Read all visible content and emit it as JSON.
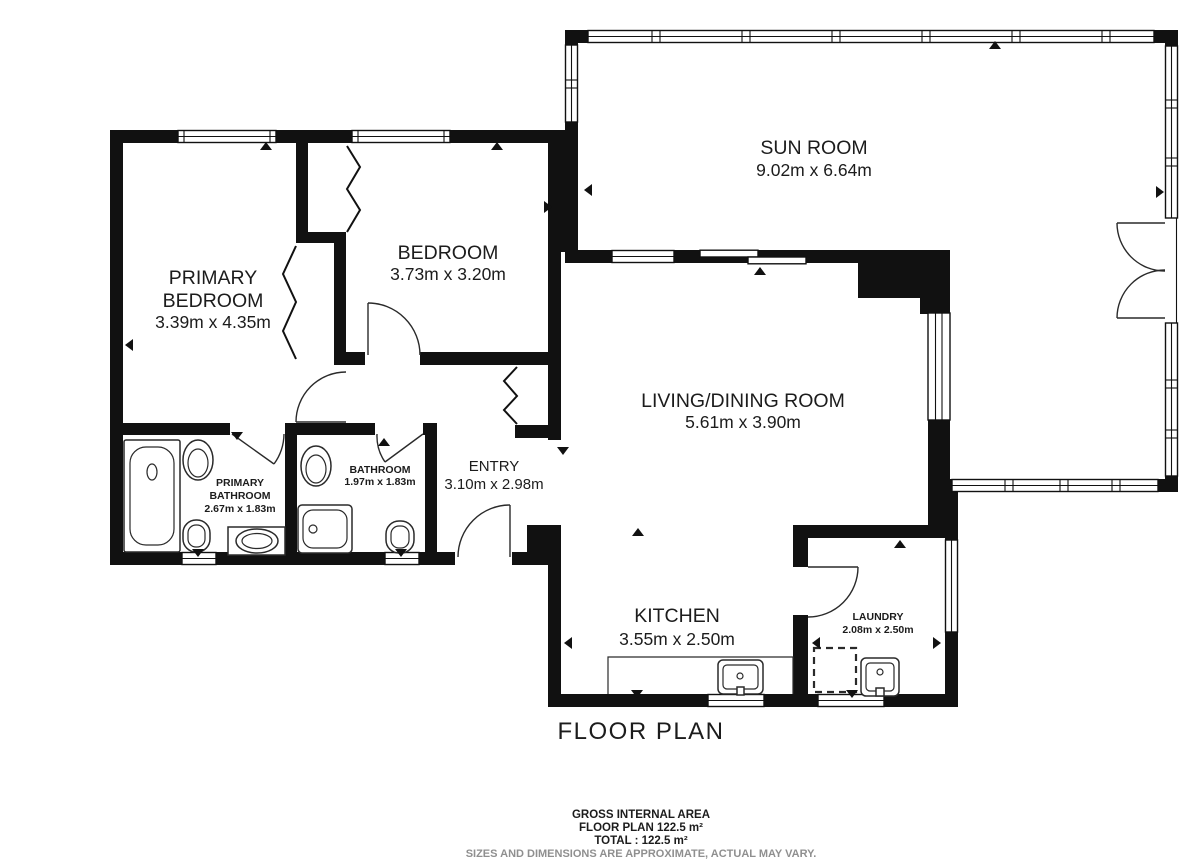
{
  "plan": {
    "title": "FLOOR PLAN",
    "rooms": {
      "sun_room": {
        "name": "SUN ROOM",
        "dims": "9.02m x 6.64m"
      },
      "primary_bedroom": {
        "line1": "PRIMARY",
        "line2": "BEDROOM",
        "dims": "3.39m x 4.35m"
      },
      "bedroom": {
        "name": "BEDROOM",
        "dims": "3.73m x 3.20m"
      },
      "living_dining": {
        "name": "LIVING/DINING ROOM",
        "dims": "5.61m x 3.90m"
      },
      "primary_bathroom": {
        "line1": "PRIMARY",
        "line2": "BATHROOM",
        "dims": "2.67m x 1.83m"
      },
      "bathroom": {
        "name": "BATHROOM",
        "dims": "1.97m x 1.83m"
      },
      "entry": {
        "name": "ENTRY",
        "dims": "3.10m x 2.98m"
      },
      "kitchen": {
        "name": "KITCHEN",
        "dims": "3.55m x 2.50m"
      },
      "laundry": {
        "name": "LAUNDRY",
        "dims": "2.08m x 2.50m"
      }
    },
    "footer": {
      "area_heading": "GROSS INTERNAL AREA",
      "area_line": "FLOOR PLAN 122.5 m²",
      "total_line": "TOTAL :  122.5 m²",
      "disclaimer": "SIZES AND DIMENSIONS ARE APPROXIMATE, ACTUAL MAY VARY."
    },
    "colors": {
      "wall": "#111111",
      "background": "#ffffff",
      "muted": "#8f8f8f"
    }
  }
}
